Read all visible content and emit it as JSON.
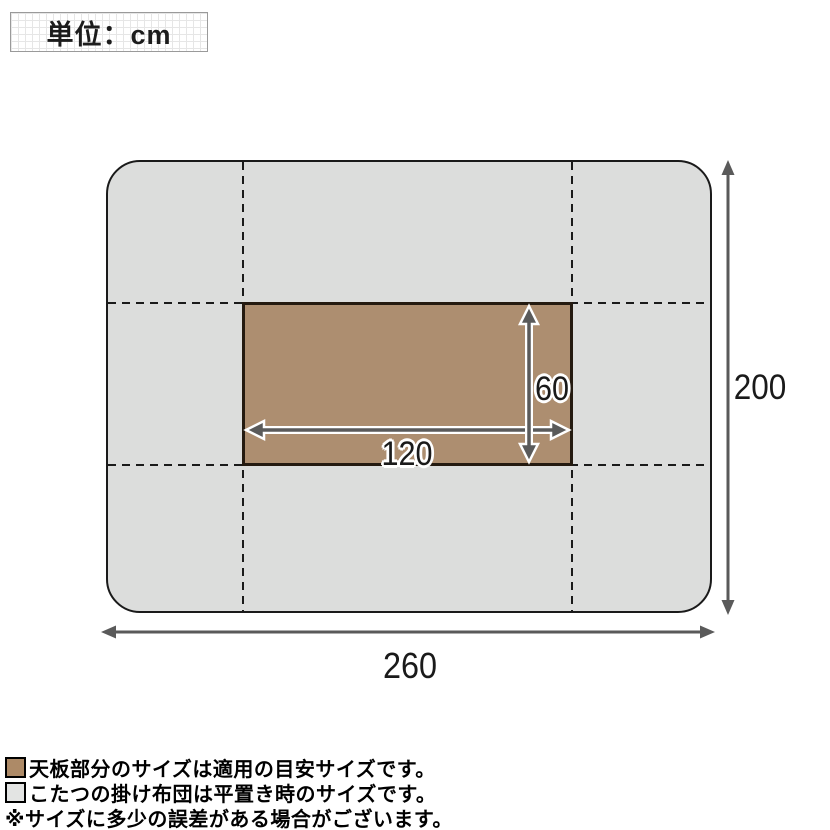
{
  "unit_box": {
    "label": "単位：cm"
  },
  "dimensions": {
    "futon_width": {
      "value": "260"
    },
    "futon_height": {
      "value": "200"
    },
    "tabletop_width": {
      "value": "120"
    },
    "tabletop_height": {
      "value": "60"
    }
  },
  "legend": {
    "items": [
      {
        "swatch": "tabletop-brown",
        "text": "天板部分のサイズは適用の目安サイズです。"
      },
      {
        "swatch": "futon-gray",
        "text": "こたつの掛け布団は平置き時のサイズです。"
      }
    ],
    "note": "※サイズに多少の誤差がある場合がございます。"
  },
  "colors": {
    "futon_fill": "#dcdddc",
    "tabletop_fill": "#ad8e70",
    "outline": "#1a1a1a",
    "arrow": "#5a5a5a",
    "legend_gray_swatch": "#e3e4e3",
    "legend_brown_swatch": "#ad8a67"
  }
}
